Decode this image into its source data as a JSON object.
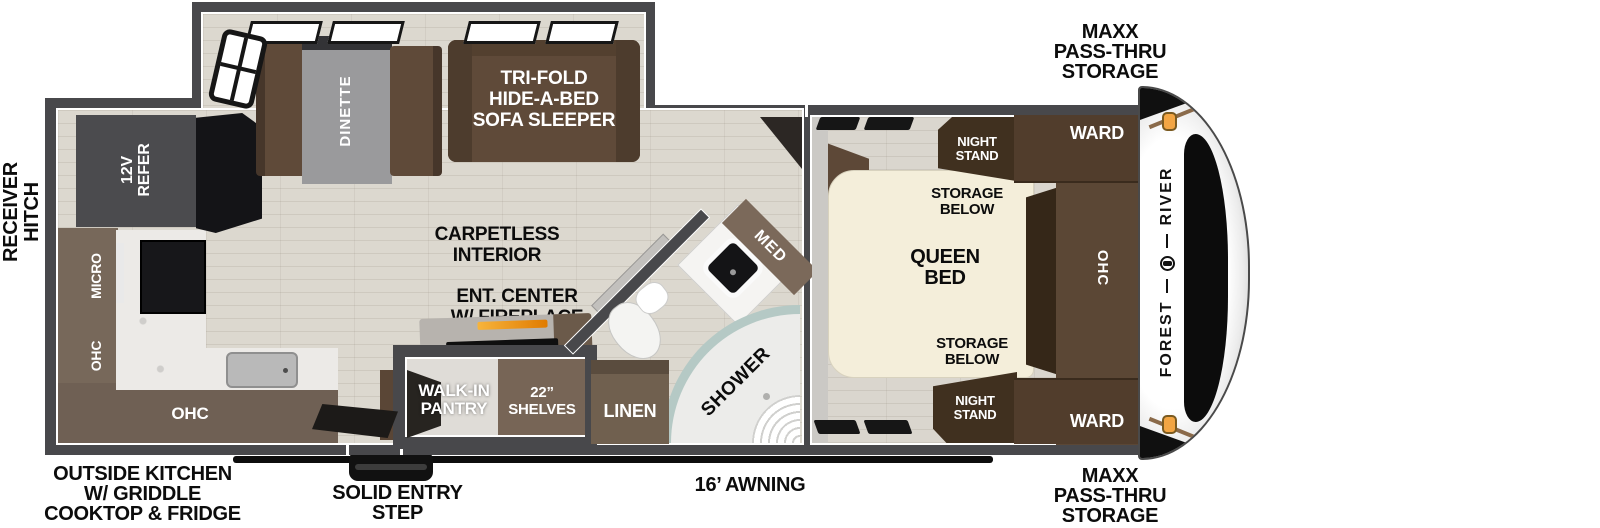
{
  "labels": {
    "receiver_hitch": [
      "RECEIVER",
      "HITCH"
    ],
    "maxx_storage_top": [
      "MAXX",
      "PASS-THRU",
      "STORAGE"
    ],
    "maxx_storage_bottom": [
      "MAXX",
      "PASS-THRU",
      "STORAGE"
    ],
    "outside_kitchen": [
      "OUTSIDE KITCHEN",
      "W/ GRIDDLE",
      "COOKTOP & FRIDGE"
    ],
    "solid_entry_step": [
      "SOLID ENTRY",
      "STEP"
    ],
    "awning": "16’ AWNING",
    "refer": [
      "12V",
      "REFER"
    ],
    "micro": "MICRO",
    "ohc_kitchen_wall": "OHC",
    "ohc_kitchen_lower": "OHC",
    "dinette": "DINETTE",
    "sofa": [
      "TRI-FOLD",
      "HIDE-A-BED",
      "SOFA SLEEPER"
    ],
    "carpetless": [
      "CARPETLESS",
      "INTERIOR"
    ],
    "ent_center": [
      "ENT. CENTER",
      "W/ FIREPLACE"
    ],
    "walk_in_pantry": [
      "WALK-IN",
      "PANTRY"
    ],
    "shelves": [
      "22”",
      "SHELVES"
    ],
    "linen": "LINEN",
    "med": "MED",
    "shower": "SHOWER",
    "night_stand_top": [
      "NIGHT",
      "STAND"
    ],
    "night_stand_bottom": [
      "NIGHT",
      "STAND"
    ],
    "storage_below_top": [
      "STORAGE",
      "BELOW"
    ],
    "storage_below_bottom": [
      "STORAGE",
      "BELOW"
    ],
    "queen_bed": [
      "QUEEN",
      "BED"
    ],
    "ward_top": "WARD",
    "ward_bottom": "WARD",
    "ohc_bedroom": "OHC",
    "brand_word1": "FOREST",
    "brand_word2": "RIVER"
  },
  "colors": {
    "wall": "#48484b",
    "floor": "#dcd8cf",
    "floor_bedroom": "#dad6ce",
    "furniture_brown": "#5f4a39",
    "cabinet_dark_brown": "#4e3b2b",
    "overhead_band": "#77685a",
    "bed_cream": "#f4eeda",
    "counter_marble": "#eceae7",
    "table_gray": "#9a9a9c",
    "shower_glass": "#b5c9c5",
    "fireplace_orange": "#e9930e",
    "cap_marker_light": "#f2a544",
    "label_black": "#0c0c0c",
    "label_white": "#ffffff"
  }
}
